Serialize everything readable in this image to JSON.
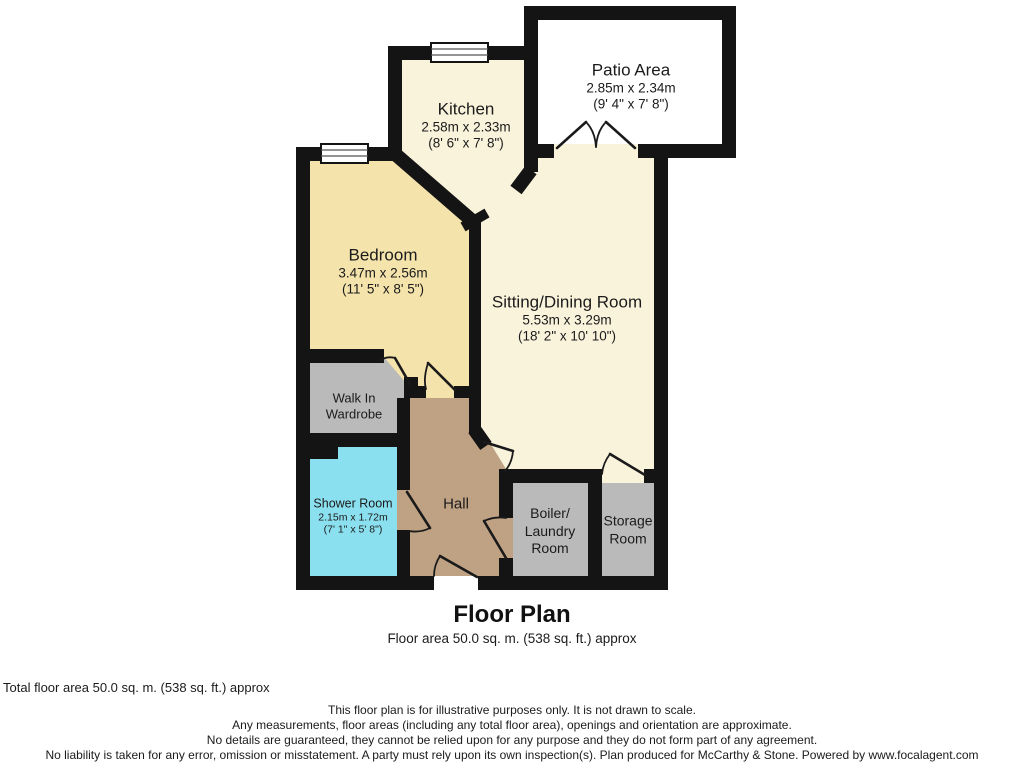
{
  "plan": {
    "title": "Floor Plan",
    "subtitle": "Floor area 50.0 sq. m. (538 sq. ft.) approx",
    "rooms": {
      "patio": {
        "name": "Patio Area",
        "dims_m": "2.85m x 2.34m",
        "dims_ft": "(9' 4\" x 7' 8\")"
      },
      "kitchen": {
        "name": "Kitchen",
        "dims_m": "2.58m x 2.33m",
        "dims_ft": "(8' 6\" x 7' 8\")"
      },
      "bedroom": {
        "name": "Bedroom",
        "dims_m": "3.47m x 2.56m",
        "dims_ft": "(11' 5\" x 8' 5\")"
      },
      "sitting": {
        "name": "Sitting/Dining Room",
        "dims_m": "5.53m x 3.29m",
        "dims_ft": "(18' 2\" x 10' 10\")"
      },
      "wardrobe": {
        "line1": "Walk In",
        "line2": "Wardrobe"
      },
      "shower": {
        "name": "Shower Room",
        "dims_m": "2.15m x 1.72m",
        "dims_ft": "(7' 1\" x 5' 8\")"
      },
      "hall": {
        "name": "Hall"
      },
      "boiler": {
        "line1": "Boiler/",
        "line2": "Laundry",
        "line3": "Room"
      },
      "storage": {
        "line1": "Storage",
        "line2": "Room"
      }
    },
    "colors": {
      "wall": "#141414",
      "kitchen_sitting_floor": "#FAF3DC",
      "bedroom_floor": "#F5E3AC",
      "utility_floor_gray": "#BABABA",
      "shower_floor": "#8BE0EF",
      "hall_floor": "#BFA284",
      "patio_floor": "#FFFFFF"
    }
  },
  "footer": {
    "total_area": "Total floor area 50.0 sq. m. (538 sq. ft.) approx",
    "disclaimer_lines": [
      "This floor plan is for illustrative purposes only. It is not drawn to scale.",
      "Any measurements, floor areas (including any total floor area), openings and orientation are approximate.",
      "No details are guaranteed, they cannot be relied upon for any purpose and they do not form part of any agreement.",
      "No liability is taken for any error, omission or misstatement. A party must rely upon its own inspection(s). Plan produced for McCarthy & Stone. Powered by www.focalagent.com"
    ]
  }
}
